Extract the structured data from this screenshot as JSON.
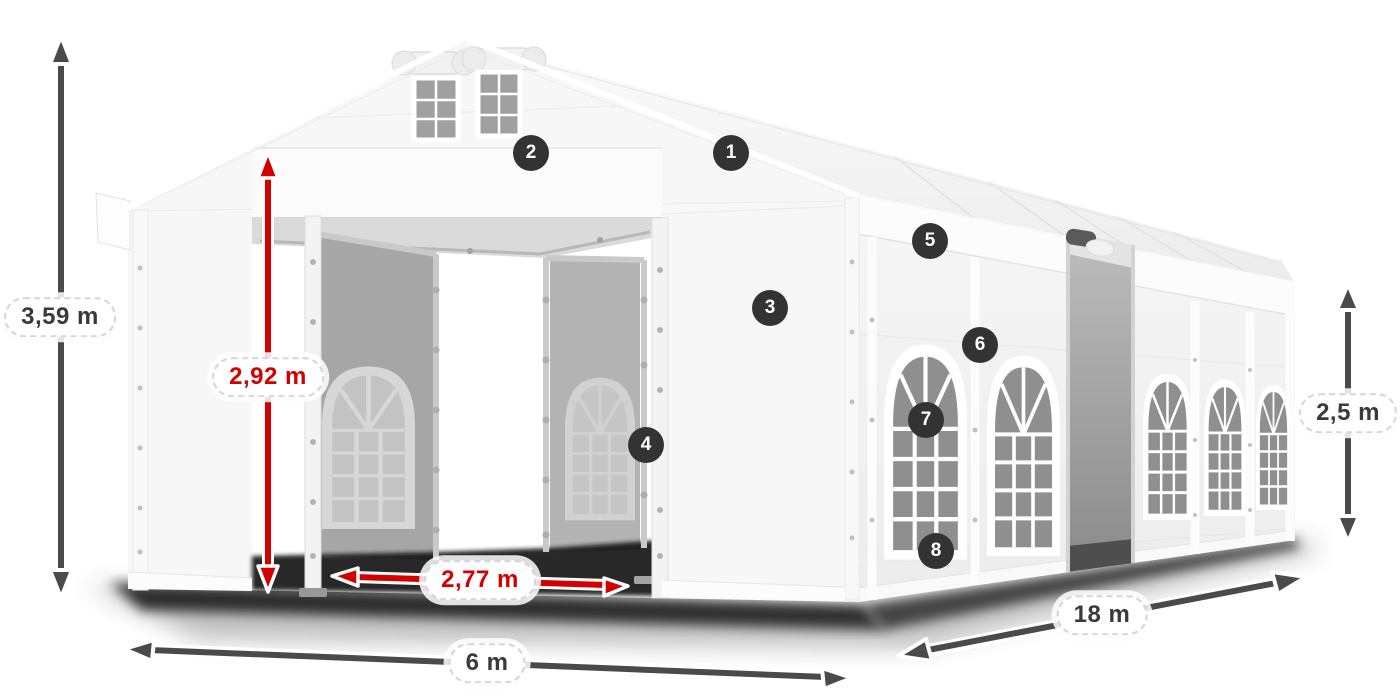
{
  "page": {
    "background": "#ffffff",
    "description": "Dimensioned product illustration of a white 6 x 18 m marquee party tent with open front entrance and open side door, shown in three-quarter view"
  },
  "dimensions": {
    "total_height": "3,59 m",
    "entrance_height": "2,92 m",
    "entrance_width": "2,77 m",
    "width": "6 m",
    "length": "18 m",
    "side_height": "2,5 m"
  },
  "badges": [
    "1",
    "2",
    "3",
    "4",
    "5",
    "6",
    "7",
    "8"
  ],
  "colors": {
    "accent_red": "#d40000",
    "arrow_gray": "#4a4a4a",
    "badge_bg": "#333333",
    "label_text": "#3a3a3a",
    "page_bg": "#ffffff",
    "tent_white": "#f6f6f6",
    "window_glass": "#8f8f8f"
  }
}
